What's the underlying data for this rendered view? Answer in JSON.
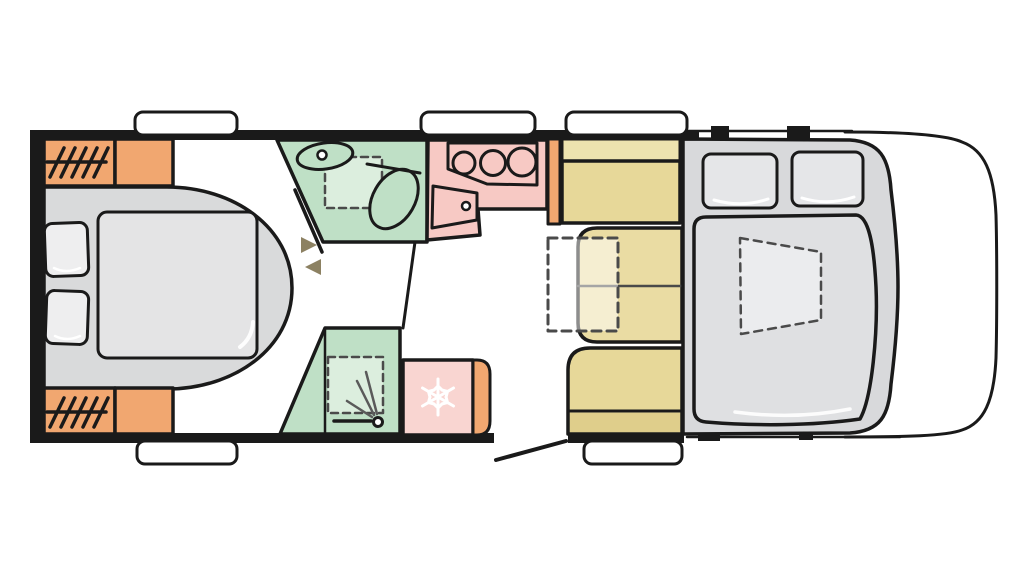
{
  "diagram": {
    "kind": "motorhome-floorplan",
    "visible_text": []
  },
  "features": [
    "rear-island-bed",
    "bed-pillow",
    "wardrobe-hanging-rail",
    "storage-cabinet",
    "window-opening",
    "washroom",
    "washbasin",
    "tap",
    "toilet",
    "shower-tray",
    "swivel-wall-arrows",
    "bathroom-door",
    "kitchen-counter",
    "hob-3-burner",
    "cabinet-door-with-knob",
    "fridge-freezer",
    "snowflake-icon",
    "dinette-bench",
    "facing-seats",
    "folding-table",
    "drop-down-cab-bed",
    "cab-mattress",
    "roof-skylight",
    "entry-door",
    "vehicle-cab-nose"
  ],
  "colors": {
    "outline": "#1a1a1a",
    "wall": "#1a1a1a",
    "white": "#ffffff",
    "orange": "#f1a770",
    "seatYellow": "#e7d899",
    "seatYellowLight": "#ede3af",
    "seatYellowSeats": "#eadca3",
    "seatYellowDark": "#dfce8b",
    "green": "#bfe0c6",
    "greenLight": "#dceede",
    "pink": "#f7c9c4",
    "pinkLight": "#f9d5d1",
    "grayBase": "#d9dadb",
    "grayMattress": "#e4e4e5",
    "grayPillow": "#eeeeef",
    "cabGray": "#d8d9db",
    "cabMattress": "#dfe0e2",
    "cabPillow": "#e5e6e8",
    "cabSkylight": "#ebecee",
    "arrow": "#8c8162",
    "dash": "#4a4a4a",
    "ray": "#5a5a5a",
    "highlight": "#ffffff"
  }
}
